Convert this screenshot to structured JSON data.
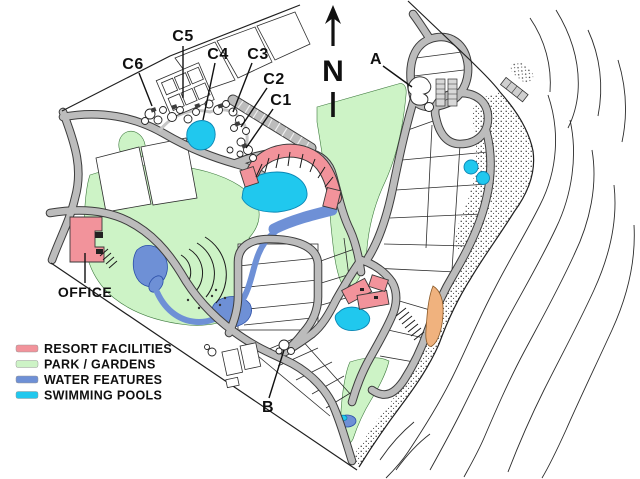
{
  "map": {
    "north_label": "N",
    "markers": [
      {
        "id": "c6",
        "text": "C6"
      },
      {
        "id": "c5",
        "text": "C5"
      },
      {
        "id": "c4",
        "text": "C4"
      },
      {
        "id": "c3",
        "text": "C3"
      },
      {
        "id": "c2",
        "text": "C2"
      },
      {
        "id": "c1",
        "text": "C1"
      },
      {
        "id": "a",
        "text": "A"
      },
      {
        "id": "b",
        "text": "B"
      },
      {
        "id": "office",
        "text": "OFFICE"
      }
    ]
  },
  "legend": {
    "items": [
      {
        "label": "RESORT FACILITIES",
        "color": "#f2939b"
      },
      {
        "label": "PARK / GARDENS",
        "color": "#cdf3c6"
      },
      {
        "label": "WATER FEATURES",
        "color": "#6e90d6"
      },
      {
        "label": "SWIMMING POOLS",
        "color": "#20c8ee"
      }
    ]
  },
  "colors": {
    "road": "#bcbcbc",
    "resort_facility": "#f2939b",
    "park": "#cdf3c6",
    "water": "#6e90d6",
    "pool": "#20c8ee",
    "sand": "#f0b27e"
  }
}
